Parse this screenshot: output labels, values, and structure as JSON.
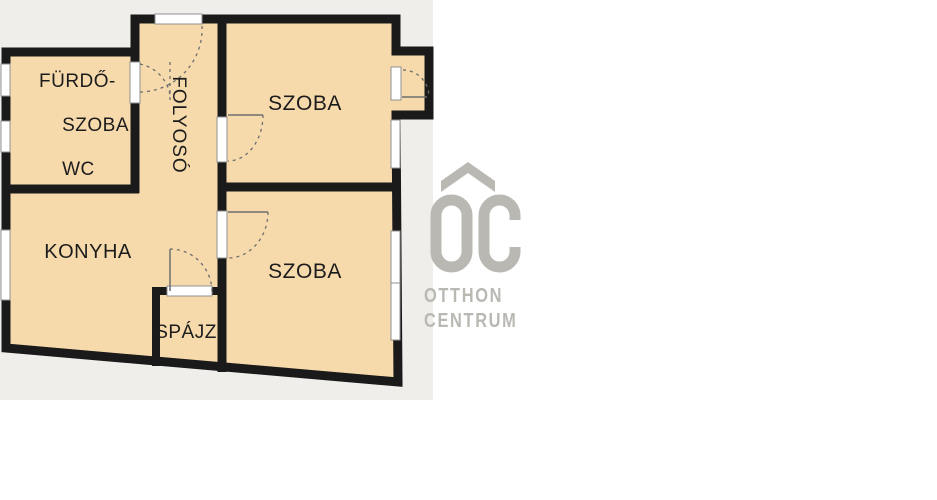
{
  "colors": {
    "page": "#ffffff",
    "panel": "#efeeea",
    "plan-fill": "#f6daac",
    "wall": "#1a1a1a",
    "frame": "#909090",
    "door": "#6e6e6e",
    "label": "#1c1c1c",
    "logo": "#b9b8b3"
  },
  "rooms": {
    "bathroom": {
      "line1": "FÜRDŐ-",
      "line2": "SZOBA",
      "line3": "WC"
    },
    "hallway": {
      "label": "FOLYOSÓ"
    },
    "room_top": {
      "label": "SZOBA"
    },
    "room_bottom": {
      "label": "SZOBA"
    },
    "kitchen": {
      "label": "KONYHA"
    },
    "pantry": {
      "label": "SPÁJZ"
    }
  },
  "watermark": {
    "monogram": "OC",
    "line1": "OTTHON",
    "line2": "CENTRUM"
  }
}
